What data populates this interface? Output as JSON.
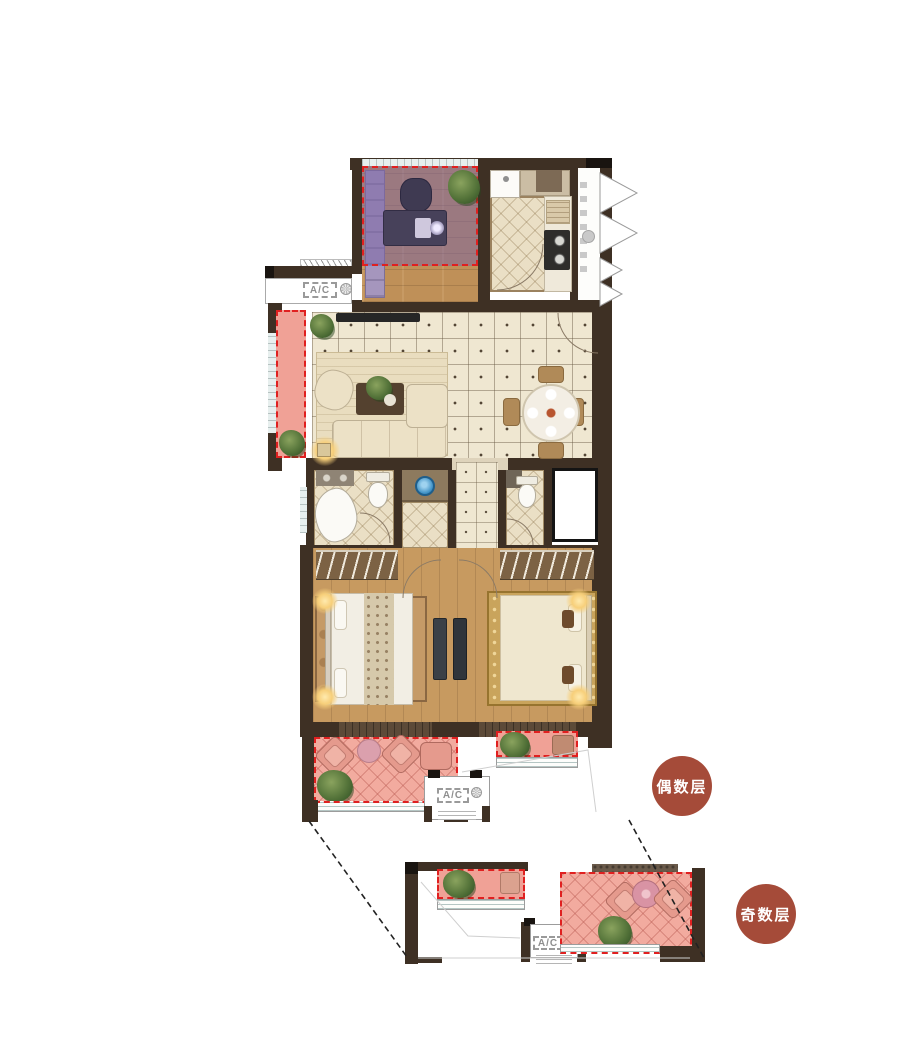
{
  "labels": {
    "ac": "A/C"
  },
  "badges": {
    "even": "偶数层",
    "odd": "奇数层"
  },
  "colors": {
    "badge": "#a54b39",
    "wall": "#3e3024",
    "balcony_pink": "#f0a196",
    "study_highlight_purple": "#7b63a4",
    "highlight_dash_red": "#e02020",
    "tile_cream": "#efe7d1",
    "wood_floor": "#c79a60",
    "window_glass": "#e7efee",
    "basin_blue": "#2f86bd"
  }
}
